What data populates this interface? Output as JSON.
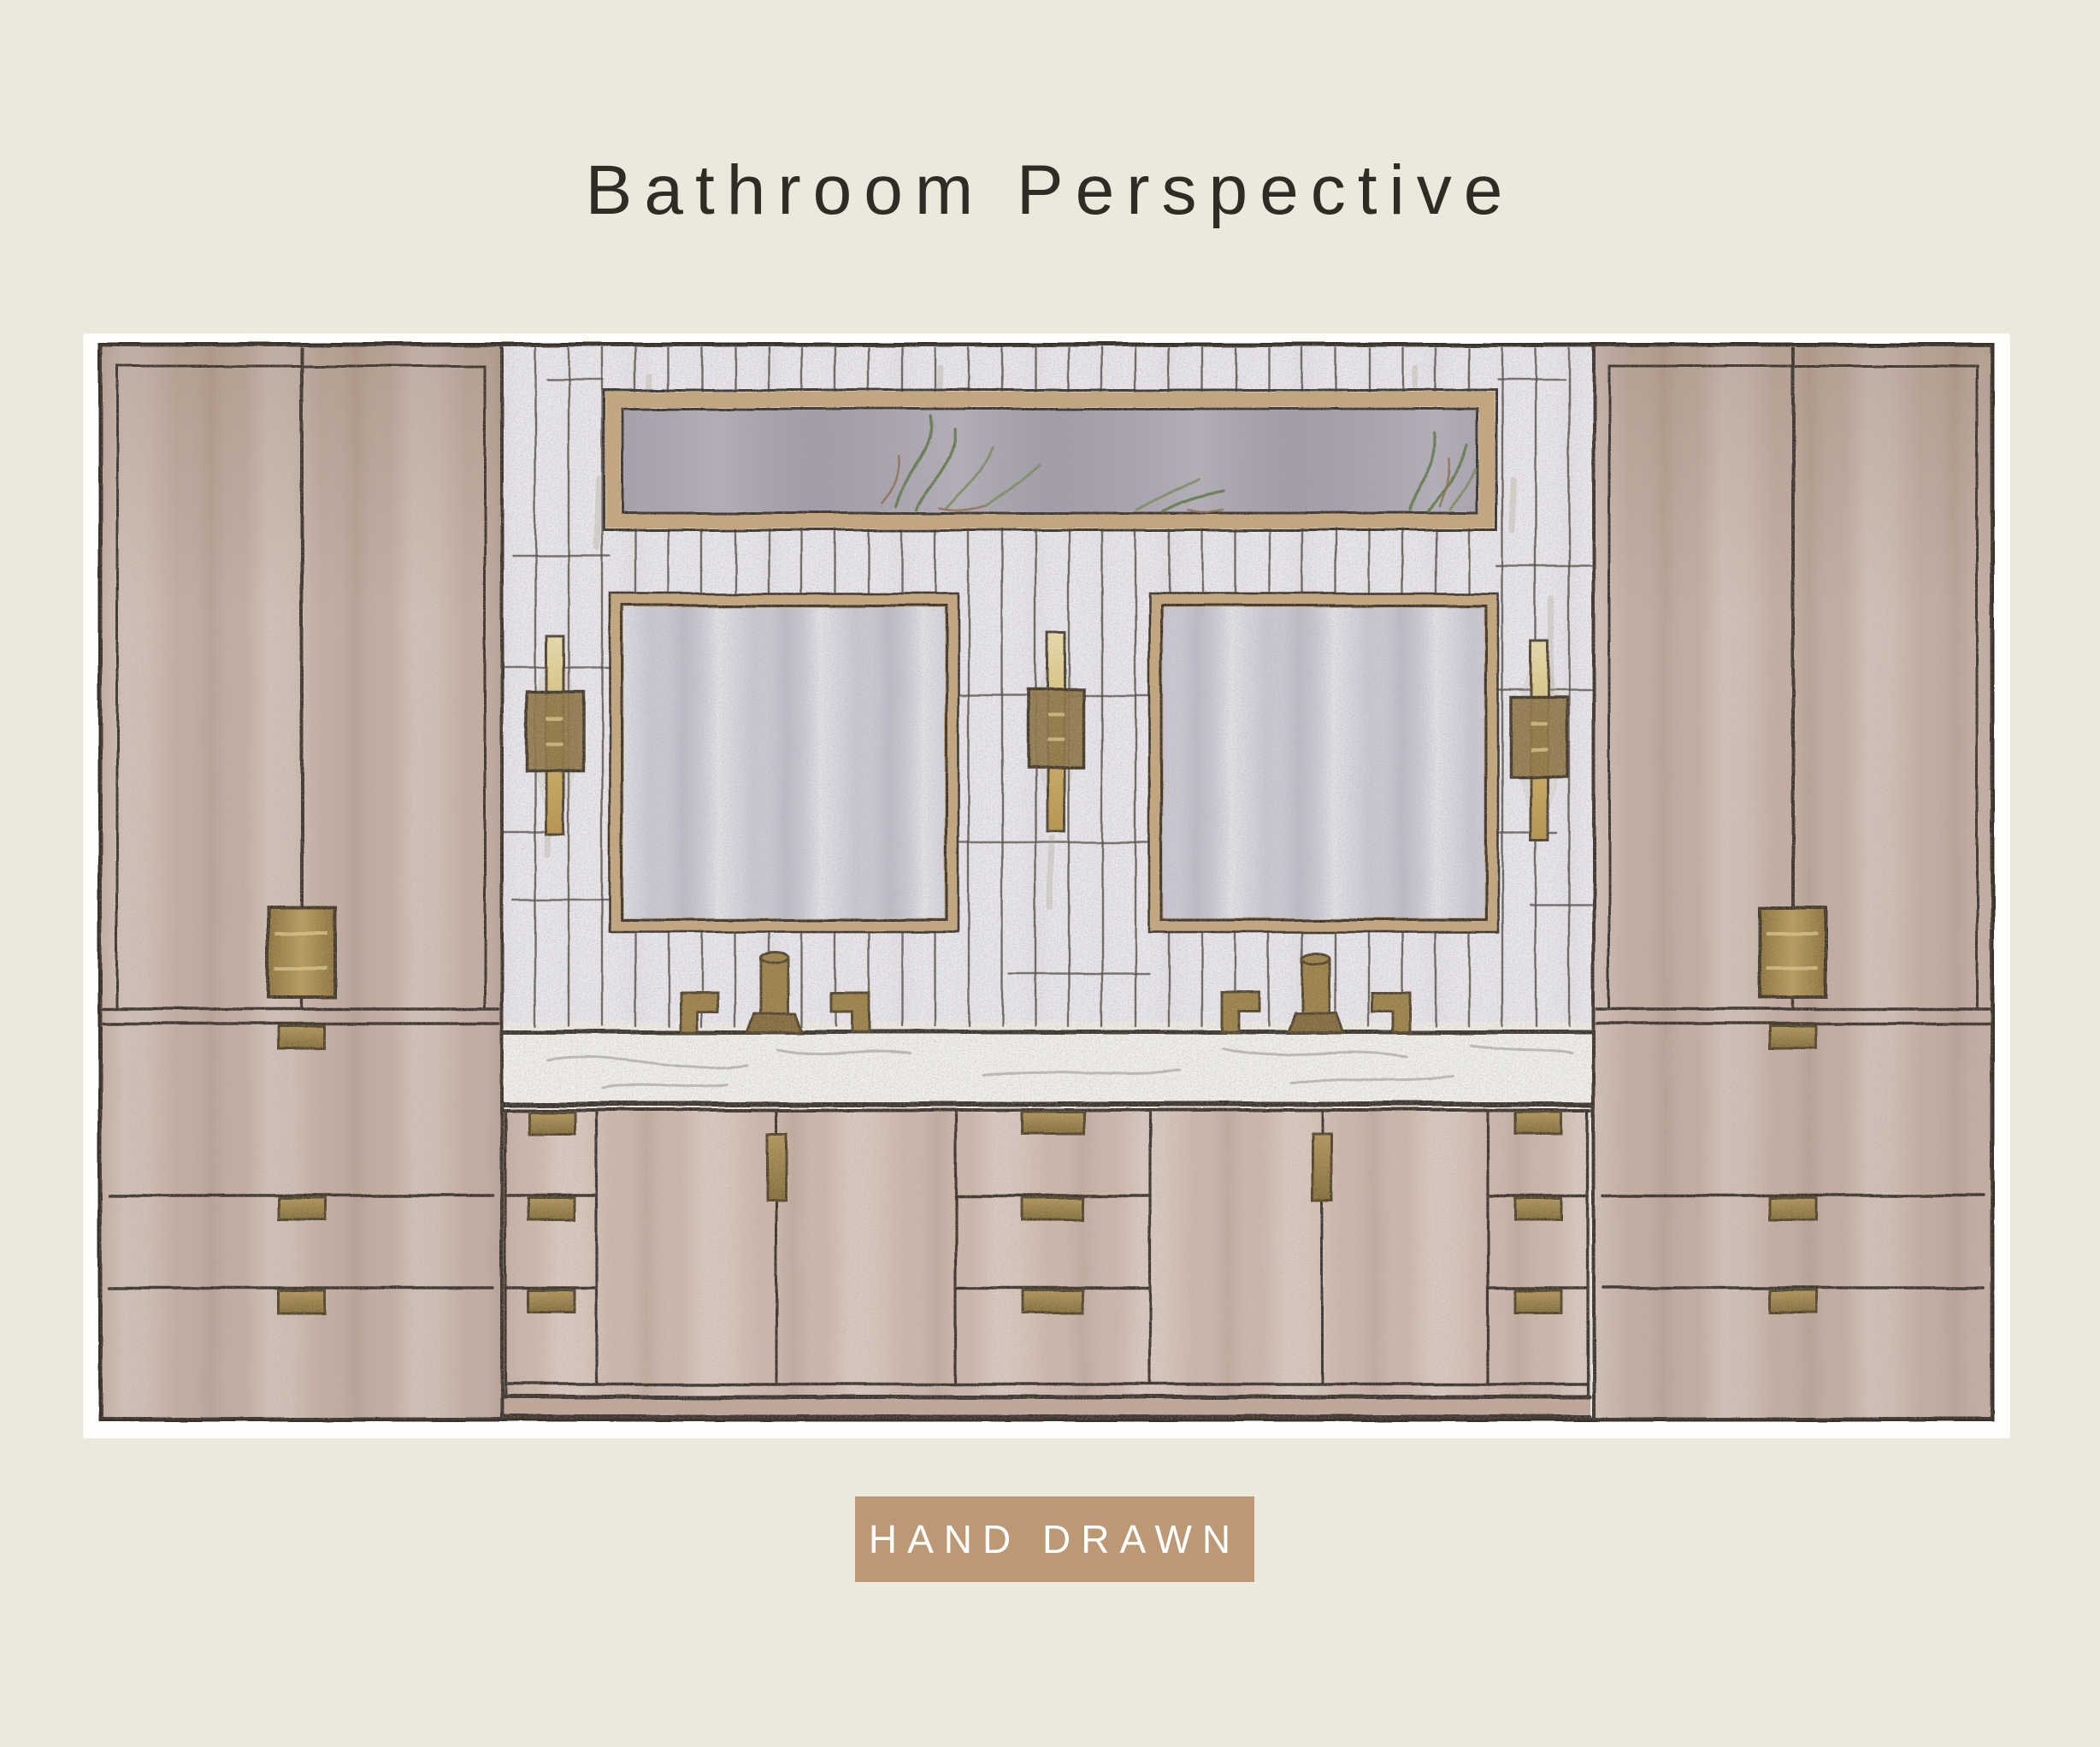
{
  "title": {
    "text": "Bathroom Perspective",
    "color": "#2f2c26"
  },
  "badge": {
    "label": "HAND DRAWN",
    "background": "#bd9874",
    "text_color": "#ffffff"
  },
  "page": {
    "background": "#ebe9dc",
    "mat_color": "#fdfdfc"
  },
  "drawing": {
    "medium": "hand-drawn marker and colored-pencil interior elevation",
    "scene": "double-vanity bathroom wall",
    "elements": [
      "left-tall-cabinet",
      "right-tall-cabinet",
      "vertical-tile-wall",
      "framed-botanical-art-transom",
      "left-mirror",
      "right-mirror",
      "wall-sconce-left",
      "wall-sconce-center",
      "wall-sconce-right",
      "pendant-light-left",
      "pendant-light-right",
      "marble-countertop",
      "widespread-faucet-left",
      "widespread-faucet-right",
      "vanity-door-pairs",
      "vanity-drawer-banks",
      "brass-pulls",
      "toe-kick"
    ],
    "palette": {
      "outline": "#38302a",
      "wood_wash": "#c3ada1",
      "wood_light": "#d7c5b9",
      "tile": "#e9e7ee",
      "tile_line": "#49423c",
      "mirror_glass": "#c9c7d5",
      "frame_gold": "#c4a67c",
      "brass": "#a3874a",
      "bronze_dark": "#6b5836",
      "art_interior": "#a5a1ae",
      "art_green": "#5d7747",
      "counter": "#f1f0ec"
    }
  }
}
